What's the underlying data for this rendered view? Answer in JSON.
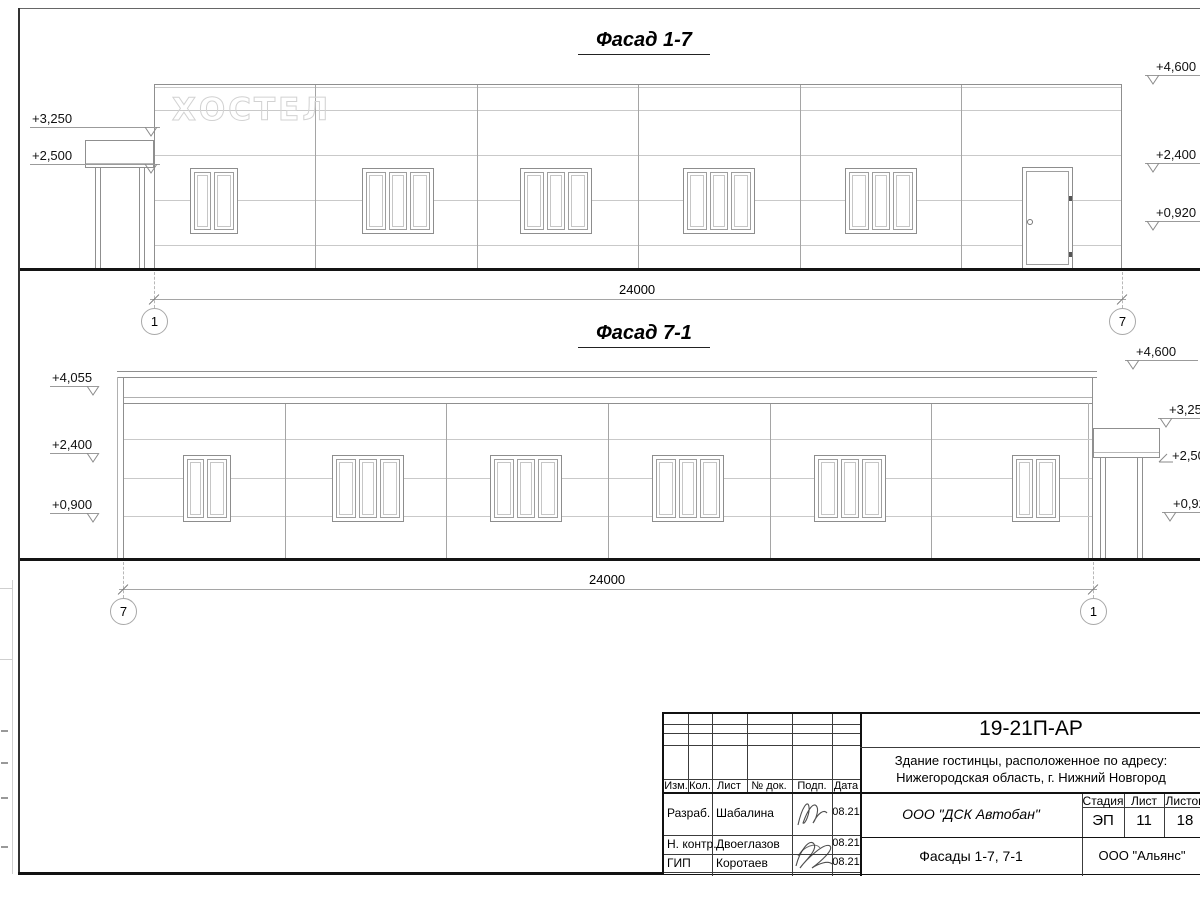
{
  "sheet": {
    "facade_1_7": {
      "title": "Фасад 1-7",
      "sign": "ХОСТЕЛ",
      "dimension": "24000",
      "axis_left": "1",
      "axis_right": "7",
      "levels_left": [
        "+3,250",
        "+2,500"
      ],
      "levels_right": [
        "+4,600",
        "+2,400",
        "+0,920"
      ]
    },
    "facade_7_1": {
      "title": "Фасад 7-1",
      "dimension": "24000",
      "axis_left": "7",
      "axis_right": "1",
      "levels_left": [
        "+4,055",
        "+2,400",
        "+0,900"
      ],
      "levels_right": [
        "+4,600",
        "+3,250",
        "+2,500",
        "+0,920"
      ]
    },
    "title_block": {
      "doc_number": "19-21П-АР",
      "project_address_line1": "Здание гостинцы, расположенное по адресу:",
      "project_address_line2": "Нижегородская область, г. Нижний Новгород",
      "revision_columns": [
        "Изм.",
        "Кол.",
        "Лист",
        "№ док.",
        "Подп.",
        "Дата"
      ],
      "signers": [
        {
          "role": "Разраб.",
          "name": "Шабалина",
          "date": "08.21"
        },
        {
          "role": "Н. контр.",
          "name": "Двоеглазов",
          "date": "08.21"
        },
        {
          "role": "ГИП",
          "name": "Коротаев",
          "date": "08.21"
        }
      ],
      "design_company": "ООО \"ДСК Автобан\"",
      "stage_label": "Стадия",
      "stage_value": "ЭП",
      "sheet_label": "Лист",
      "sheet_value": "11",
      "total_label": "Листов",
      "total_value": "18",
      "sheet_title": "Фасады 1-7, 7-1",
      "client_company": "ООО \"Альянс\""
    }
  }
}
